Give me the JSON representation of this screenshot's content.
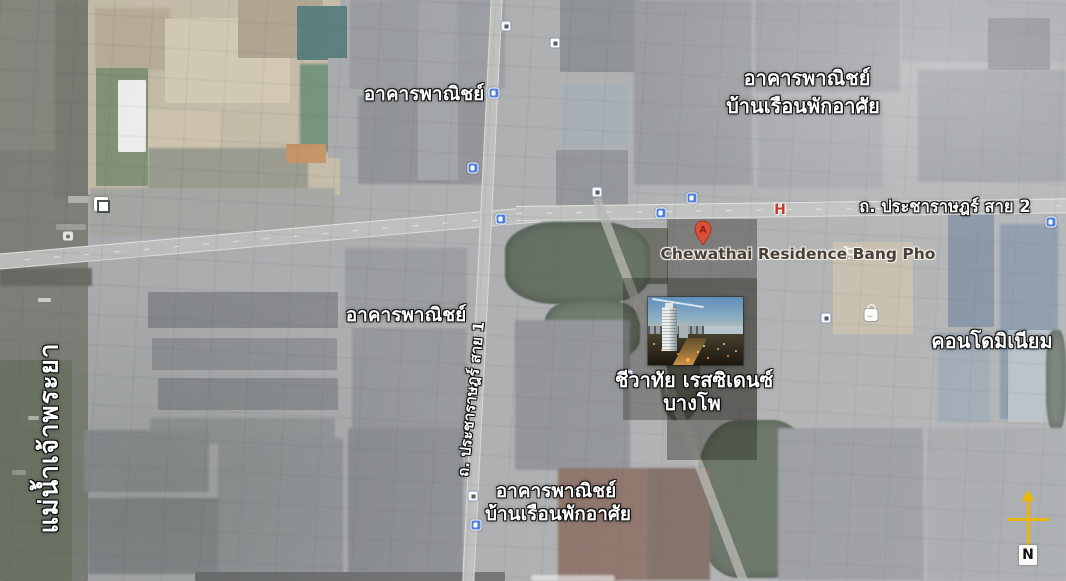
{
  "map": {
    "labels": {
      "river": "แม่น้ำเจ้าพระยา",
      "road_sai2": "ถ. ประชาราษฎร์ สาย 2",
      "road_sai1": "ถ. ประชาราษฎร์ สาย 1",
      "commercial_top": "อาคารพาณิชย์",
      "top_right_line1": "อาคารพาณิชย์",
      "top_right_line2": "บ้านเรือนพักอาศัย",
      "commercial_mid": "อาคารพาณิชย์",
      "condominium": "คอนโดมิเนียม",
      "bottom_line1": "อาคารพาณิชย์",
      "bottom_line2": "บ้านเรือนพักอาศัย",
      "poi_name_en": "Chewathai Residence Bang Pho",
      "property_line1": "ชีวาทัย เรสซิเดนซ์",
      "property_line2": "บางโพ",
      "marker_letter": "A",
      "hospital_letter": "H",
      "compass_north": "N"
    },
    "colors": {
      "label_text": "#ffffff",
      "label_halo": "#1a1a1a",
      "poi_text": "#474139",
      "marker_fill": "#dd4f3a",
      "compass": "#e8b70e",
      "transit_icon": "#4d7fdb",
      "hospital_icon": "#c23b2e"
    },
    "icons": [
      {
        "kind": "bus",
        "name": "bus-stop-icon",
        "x": 494,
        "y": 93
      },
      {
        "kind": "bus",
        "name": "bus-stop-icon",
        "x": 473,
        "y": 168
      },
      {
        "kind": "bus",
        "name": "bus-stop-icon",
        "x": 501,
        "y": 219
      },
      {
        "kind": "bus",
        "name": "bus-stop-icon",
        "x": 476,
        "y": 525
      },
      {
        "kind": "bus",
        "name": "bus-stop-icon",
        "x": 1051,
        "y": 222
      },
      {
        "kind": "bus",
        "name": "bus-stop-icon",
        "x": 692,
        "y": 198
      },
      {
        "kind": "bus",
        "name": "bus-stop-icon",
        "x": 661,
        "y": 213
      },
      {
        "kind": "sq",
        "name": "poi-square-icon",
        "x": 506,
        "y": 26
      },
      {
        "kind": "sq",
        "name": "poi-square-icon",
        "x": 555,
        "y": 43
      },
      {
        "kind": "sq",
        "name": "poi-square-icon",
        "x": 597,
        "y": 192
      },
      {
        "kind": "sq",
        "name": "poi-square-icon",
        "x": 826,
        "y": 318
      },
      {
        "kind": "sq",
        "name": "poi-square-icon",
        "x": 628,
        "y": 375
      },
      {
        "kind": "sq",
        "name": "poi-square-icon",
        "x": 474,
        "y": 92
      },
      {
        "kind": "sq",
        "name": "poi-square-icon",
        "x": 473,
        "y": 496
      },
      {
        "kind": "sqbig",
        "name": "poi-square-icon",
        "x": 101,
        "y": 204
      },
      {
        "kind": "hospital",
        "name": "hospital-icon",
        "x": 780,
        "y": 210
      },
      {
        "kind": "cart",
        "name": "shopping-cart-icon",
        "x": 852,
        "y": 253
      },
      {
        "kind": "bag",
        "name": "shopping-bag-icon",
        "x": 871,
        "y": 312
      },
      {
        "kind": "pier",
        "name": "pier-icon",
        "x": 68,
        "y": 236
      }
    ]
  }
}
